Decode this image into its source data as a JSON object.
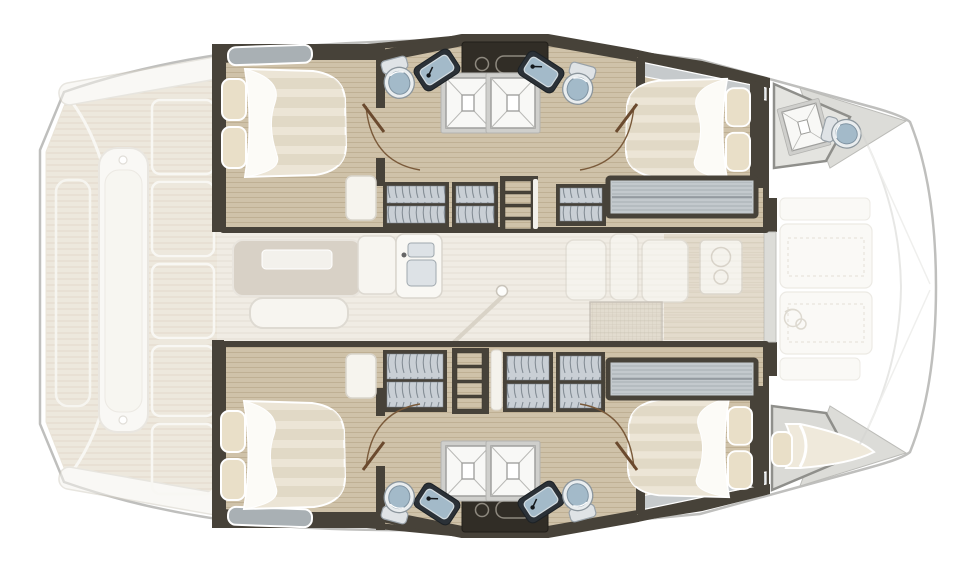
{
  "scene": {
    "kind": "catamaran-interior-deck-plan",
    "view": "top-down",
    "bow_direction": "right",
    "stern_direction": "left"
  },
  "layout": {
    "hulls": [
      {
        "id": "port-hull",
        "position": "top",
        "rooms": [
          "aft-double-cabin",
          "shared-bathroom",
          "wardrobe-corridor",
          "forward-double-cabin",
          "bow-shower-room"
        ]
      },
      {
        "id": "starboard-hull",
        "position": "bottom",
        "rooms": [
          "aft-double-cabin",
          "shared-bathroom",
          "wardrobe-corridor",
          "forward-double-cabin",
          "bow-single-berth"
        ]
      }
    ],
    "bridgedeck": {
      "rooms": [
        "saloon",
        "galley",
        "forward-galley-units"
      ],
      "items": [
        "dinette-table",
        "bench-seat",
        "galley-counter",
        "double-basin-sink",
        "support-pole",
        "cooktop",
        "vent-hatch"
      ]
    },
    "exterior": {
      "aft": [
        "cockpit-teak-deck",
        "cockpit-bench",
        "deck-hatches",
        "transom-steps"
      ],
      "fore": [
        "foredeck-locker-panels",
        "anchor-windlass",
        "bow-deck-edge",
        "trampoline-lines"
      ]
    }
  },
  "furniture_counts": {
    "double_beds": 4,
    "single_berths": 1,
    "showers": 5,
    "toilets": 5,
    "bathroom_sinks": 4,
    "galley_sinks": 1,
    "wardrobe_lockers": 6,
    "staircases": 2,
    "door_swings": 4,
    "foredeck_hatches": 2
  },
  "colors": {
    "pageBg": "#ffffff",
    "hullLine": "#bfbfbd",
    "deckTeak": "#e0d6c2",
    "deckTeakLine": "#cdbfa4",
    "deckWhite": "#f5f3ed",
    "wallDark": "#474239",
    "wallDarker": "#312d26",
    "wood": "#cfc2a9",
    "woodLine": "#bdae92",
    "saloonFloor": "#f0ece4",
    "saloonLine": "#e3ded4",
    "bedSheet": "#ece5d6",
    "bedStripe": "#dcd2bd",
    "pillow": "#e9dfc8",
    "duvet": "#fcfbf7",
    "fixBlue": "#a3bac9",
    "fixRim": "#e9edef",
    "fixDark": "#2b3137",
    "showerTray": "#f8f8f6",
    "showerLine": "#9f9f9d",
    "lockerFill": "#c9cfd5",
    "lockerArc": "#858e96",
    "winGray": "#a9b0b4",
    "bandFill": "#c3c9cd",
    "bandLine": "#a7aeb3",
    "doorArc": "#7a5a3a",
    "ghost": "#f6f4ee",
    "mesh": "#d6cdbb",
    "meshLine": "#b3a893",
    "grayDeck": "#dcdcd8",
    "grayRoom": "#e4e4e0"
  }
}
